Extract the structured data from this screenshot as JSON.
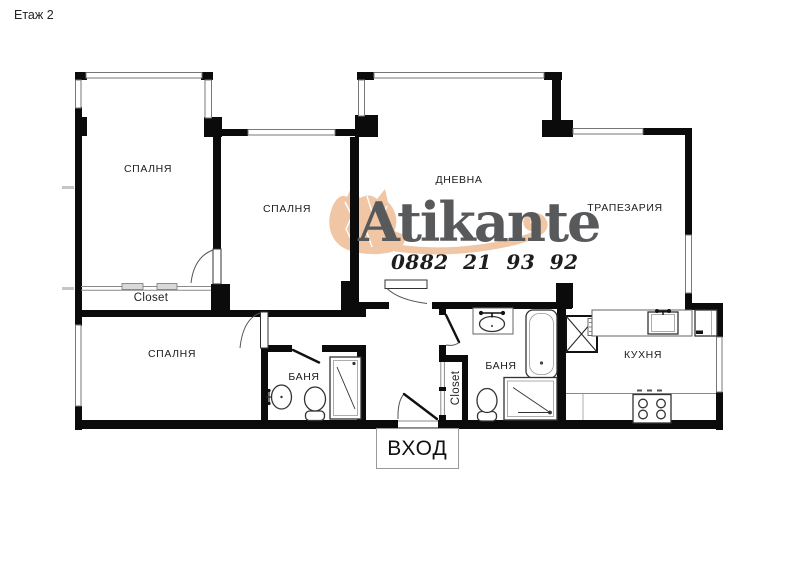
{
  "title": "Етаж 2",
  "watermark": {
    "brand": "Atikante",
    "phone": "0882 21 93 92"
  },
  "rooms": {
    "bedroom_top_left": "СПАЛНЯ",
    "bedroom_middle": "СПАЛНЯ",
    "bedroom_bottom_left": "СПАЛНЯ",
    "living_room": "ДНЕВНА",
    "dining_room": "ТРАПЕЗАРИЯ",
    "kitchen": "КУХНЯ",
    "bathroom_left": "БАНЯ",
    "bathroom_right": "БАНЯ",
    "closet_top": "Closet",
    "closet_hall": "Closet",
    "entrance": "ВХОД"
  },
  "colors": {
    "wall": "#0b0b0b",
    "thin_line": "#777777",
    "brand_text": "#58595b",
    "brand_cat": "#f0c6a5",
    "phone_text": "#1d1d1d",
    "label_text": "#1b1b1b"
  }
}
